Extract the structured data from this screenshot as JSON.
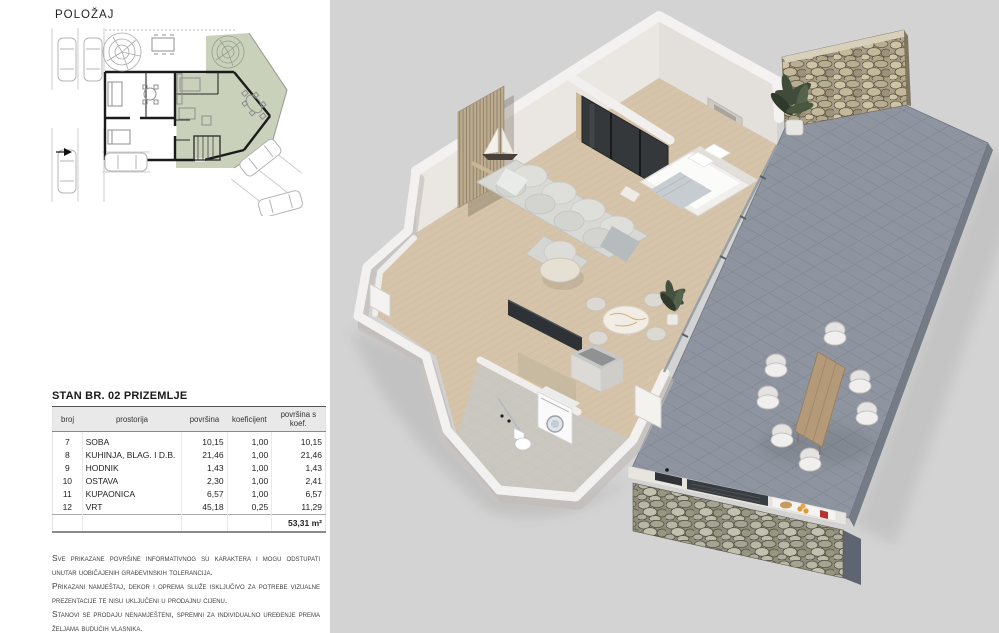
{
  "sidebar": {
    "location_heading": "POLOŽAJ",
    "table": {
      "title": "STAN BR. 02 PRIZEMLJE",
      "columns": [
        "broj",
        "prostorija",
        "površina",
        "koeficijent",
        "površina s koef."
      ],
      "rows": [
        {
          "cells": [
            "7",
            "SOBA",
            "10,15",
            "1,00",
            "10,15"
          ]
        },
        {
          "cells": [
            "8",
            "KUHINJA, BLAG. I D.B.",
            "21,46",
            "1,00",
            "21,46"
          ]
        },
        {
          "cells": [
            "9",
            "HODNIK",
            "1,43",
            "1,00",
            "1,43"
          ]
        },
        {
          "cells": [
            "10",
            "OSTAVA",
            "2,30",
            "1,00",
            "2,41"
          ]
        },
        {
          "cells": [
            "11",
            "KUPAONICA",
            "6,57",
            "1,00",
            "6,57"
          ]
        },
        {
          "cells": [
            "12",
            "VRT",
            "45,18",
            "0,25",
            "11,29"
          ]
        }
      ],
      "total": "53,31 m²"
    },
    "disclaimer": [
      "Sve prikazane površine informativnog su karaktera i mogu odstupati unutar uobičajenih građevinskih tolerancija.",
      "Prikazani namještaj, dekor i oprema služe isključivo za potrebe vizualne prezentacije te nisu uključeni u prodajnu cijenu.",
      "Stanovi se prodaju nenamješteni, spremni za individualno uređenje prema željama budućih vlasnika."
    ],
    "siteplan_colors": {
      "highlight_green": "#c9d1ba",
      "wall_black": "#1b1b1b",
      "line_gray": "#b4b4b4"
    }
  },
  "render": {
    "subject": "3D isometric cutaway of apartment 02 ground floor with garden terrace",
    "colors": {
      "background": "#d2d3d2",
      "paver": "#8f95a0",
      "paver_joint": "#7b818b",
      "wood_floor": "#d5c4aa",
      "wall_white": "#f3f1ef",
      "wall_face": "#eae6e1",
      "stone_light": "#c6bb9e",
      "stone_dark": "#958b71",
      "plant_green": "#45523e",
      "kitchen_counter": "#2e3236",
      "outdoor_table_wood": "#b49a78",
      "sofa_gray": "#d8d8d5"
    }
  }
}
